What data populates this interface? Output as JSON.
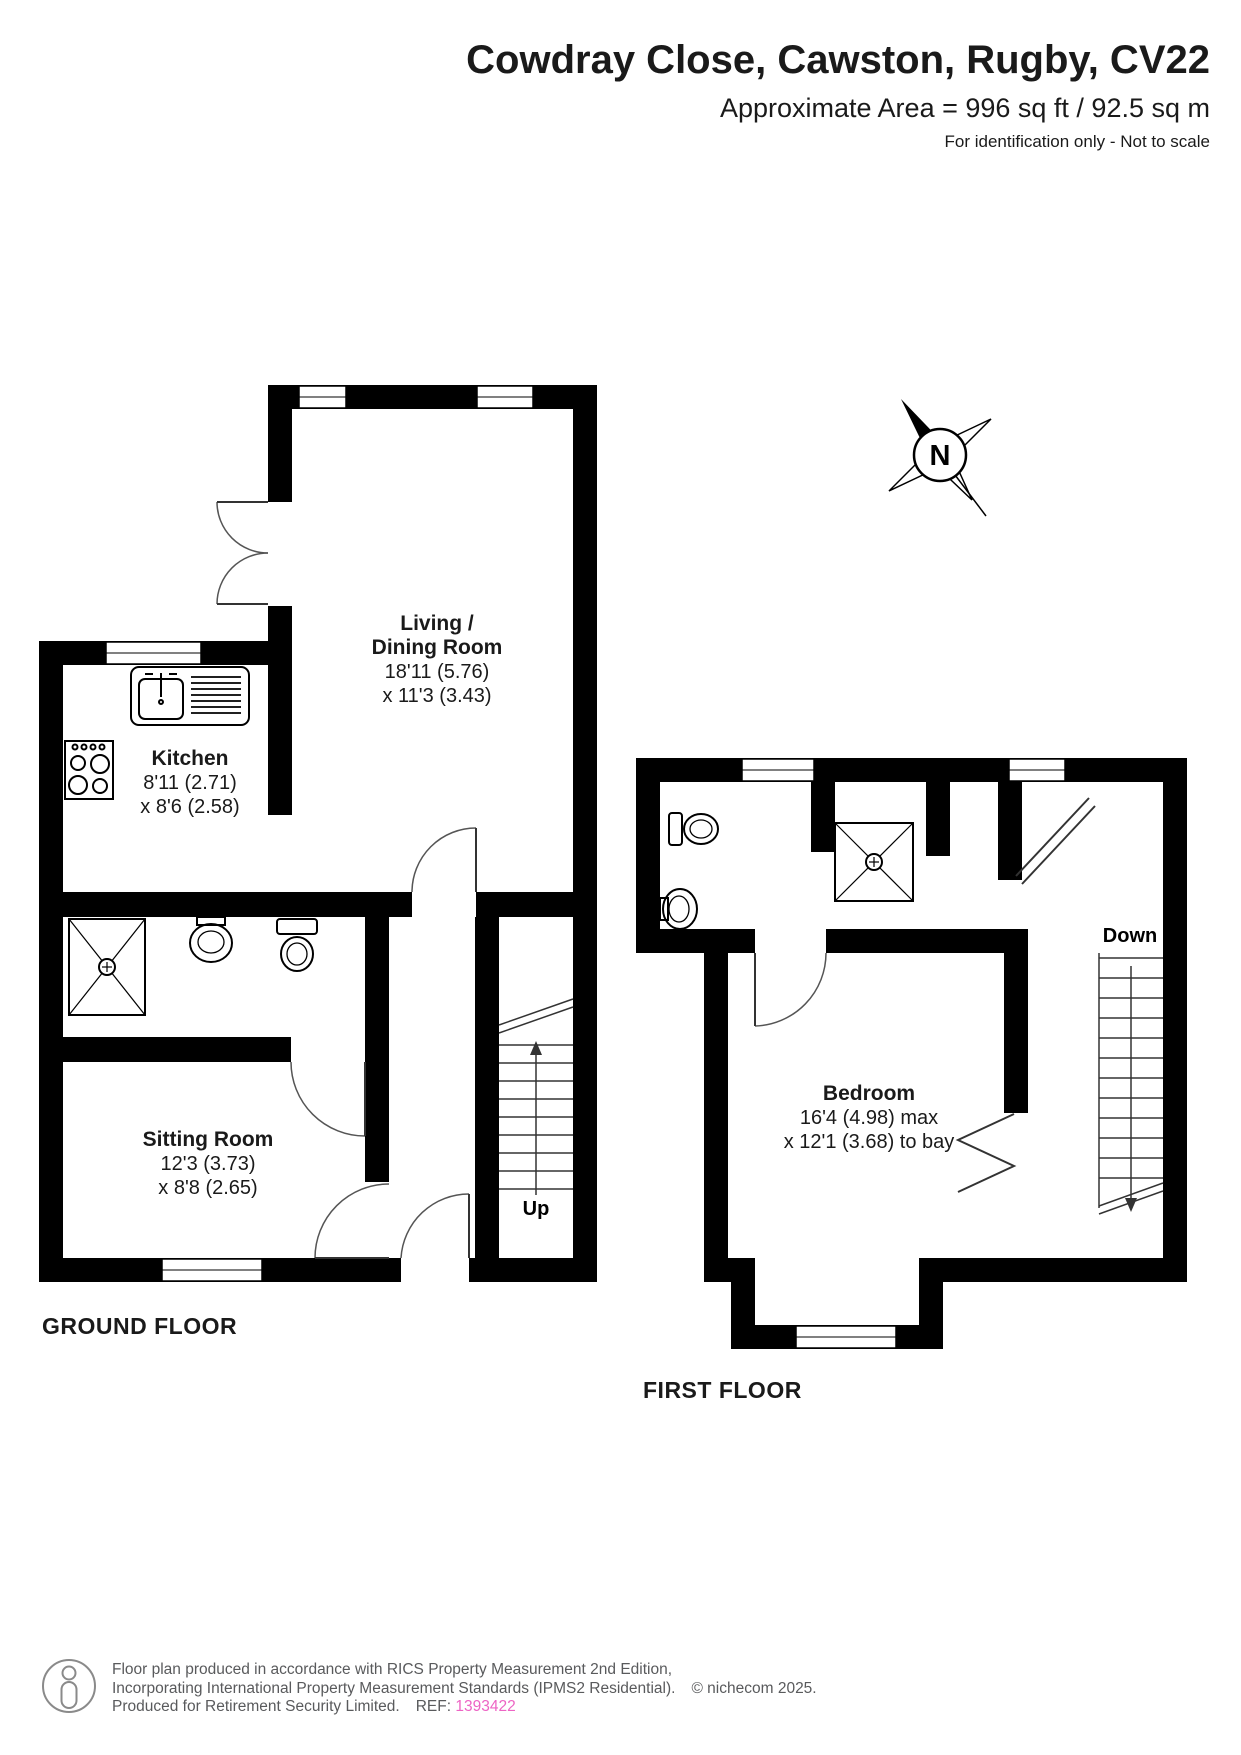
{
  "header": {
    "title": "Cowdray Close, Cawston, Rugby, CV22",
    "area_line": "Approximate Area = 996 sq ft / 92.5 sq m",
    "disclaimer": "For identification only - Not to scale"
  },
  "compass": {
    "north_label": "N"
  },
  "floors": {
    "ground": {
      "label": "GROUND FLOOR",
      "stairs_label": "Up",
      "rooms": {
        "living": {
          "name_line1": "Living /",
          "name_line2": "Dining Room",
          "dim_line1": "18'11 (5.76)",
          "dim_line2": "x 11'3 (3.43)"
        },
        "kitchen": {
          "name_line1": "Kitchen",
          "dim_line1": "8'11 (2.71)",
          "dim_line2": "x 8'6 (2.58)"
        },
        "sitting": {
          "name_line1": "Sitting Room",
          "dim_line1": "12'3 (3.73)",
          "dim_line2": "x 8'8 (2.65)"
        }
      }
    },
    "first": {
      "label": "FIRST FLOOR",
      "stairs_label": "Down",
      "rooms": {
        "bedroom": {
          "name_line1": "Bedroom",
          "dim_line1": "16'4 (4.98) max",
          "dim_line2": "x 12'1 (3.68) to bay"
        }
      }
    }
  },
  "footer": {
    "line1": "Floor plan produced in accordance with RICS Property Measurement 2nd Edition,",
    "line2": "Incorporating International Property Measurement Standards (IPMS2 Residential).",
    "copyright": "© nichecom 2025.",
    "line3": "Produced for Retirement Security Limited.",
    "ref_label": "REF:",
    "ref_value": "1393422"
  },
  "icons": [
    "compass-rose",
    "sink-icon",
    "hob-icon",
    "shower-icon",
    "basin-icon",
    "toilet-icon",
    "stairs-up-icon",
    "stairs-down-icon",
    "person-icon"
  ],
  "colors": {
    "wall": "#000000",
    "ref_accent": "#ed64c4",
    "footer_text": "#595a5c"
  }
}
